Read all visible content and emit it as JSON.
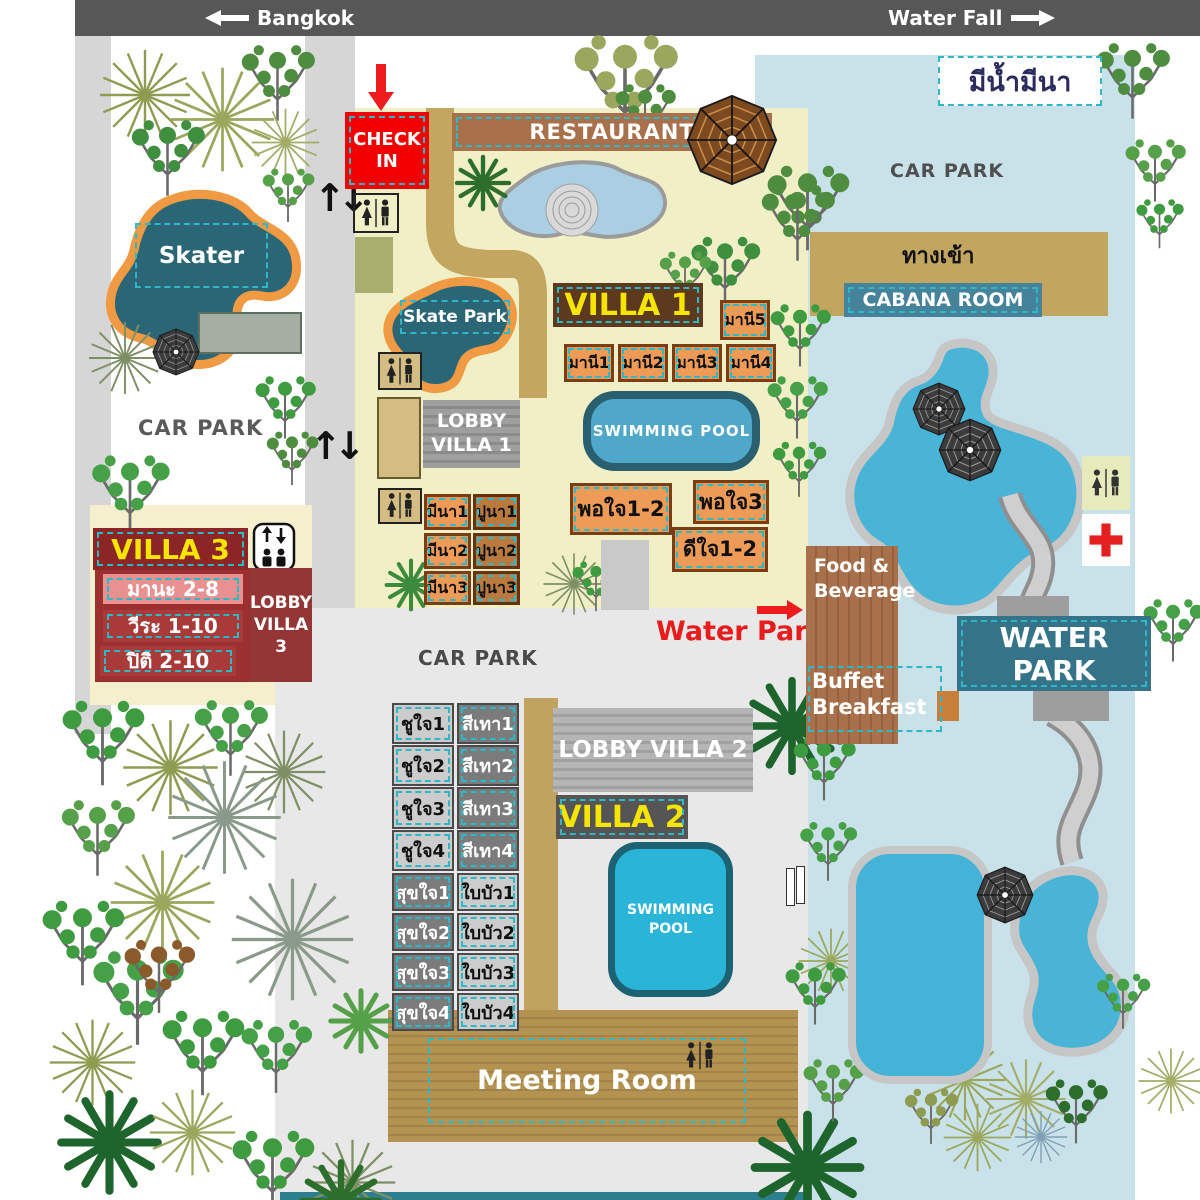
{
  "colors": {
    "dashed_accent": "#2fb7c6",
    "alert_red": "#ee1c1c",
    "water_park_bg": "#c9e2ea",
    "pool_blue": "#45b3d7",
    "road_tan": "#c2a660",
    "banner_teal": "#3a7d92"
  },
  "header": {
    "left_label": "Bangkok",
    "right_label": "Water Fall"
  },
  "sign": {
    "resort_name": "มีน้ำมีนา"
  },
  "areas": {
    "check_in": "CHECK IN",
    "restaurant": "RESTAURANT",
    "car_park_west": "CAR PARK",
    "car_park_north": "CAR PARK",
    "car_park_central": "CAR PARK",
    "entrance": "ทางเข้า",
    "cabana_room": "CABANA ROOM",
    "skater": "Skater",
    "skate_park": "Skate Park",
    "water_park_banner": "WATER PARK",
    "water_park_pointer": "Water Park",
    "food_beverage": "Food & Beverage",
    "buffet_breakfast": "Buffet Breakfast",
    "meeting_room": "Meeting Room"
  },
  "villa1": {
    "title": "VILLA 1",
    "lobby": "LOBBY VILLA 1",
    "pool": "SWIMMING POOL",
    "room_single": "มานี5",
    "rooms_row": [
      "มานี1",
      "มานี2",
      "มานี3",
      "มานี4"
    ],
    "rooms_left_col": [
      "มีนา1",
      "มีนา2",
      "มีนา3"
    ],
    "rooms_right_col": [
      "ปูนา1",
      "ปูนา2",
      "ปูนา3"
    ],
    "rooms_south": [
      "พอใจ1-2",
      "พอใจ3",
      "ดีใจ1-2"
    ]
  },
  "villa2": {
    "title": "VILLA 2",
    "lobby": "LOBBY VILLA 2",
    "pool": "SWIMMING POOL",
    "rooms_left": [
      "ชูใจ1",
      "ชูใจ2",
      "ชูใจ3",
      "ชูใจ4",
      "สุขใจ1",
      "สุขใจ2",
      "สุขใจ3",
      "สุขใจ4"
    ],
    "rooms_right": [
      "สีเทา1",
      "สีเทา2",
      "สีเทา3",
      "สีเทา4",
      "ใบบัว1",
      "ใบบัว2",
      "ใบบัว3",
      "ใบบัว4"
    ]
  },
  "villa3": {
    "title": "VILLA 3",
    "lobby": "LOBBY VILLA 3",
    "rooms": [
      "มานะ 2-8",
      "วีระ 1-10",
      "ปิติ 2-10"
    ]
  }
}
